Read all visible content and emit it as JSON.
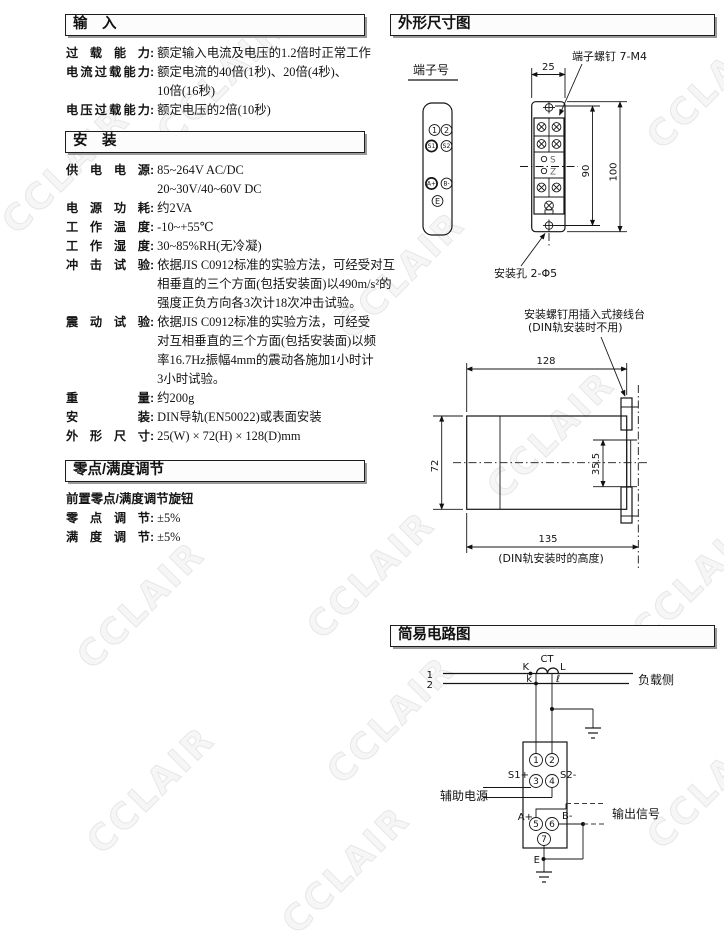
{
  "ui": {
    "colon": ":"
  },
  "watermark": {
    "text": "CCLAIR"
  },
  "input_section": {
    "title": "输　入",
    "rows": [
      {
        "label": "过载能力",
        "value": "额定输入电流及电压的1.2倍时正常工作"
      },
      {
        "label": "电流过载能力",
        "value": "额定电流的40倍(1秒)、20倍(4秒)、\n10倍(16秒)"
      },
      {
        "label": "电压过载能力",
        "value": "额定电压的2倍(10秒)"
      }
    ]
  },
  "install_section": {
    "title": "安　装",
    "rows": [
      {
        "label": "供电电源",
        "value": "85~264V AC/DC\n20~30V/40~60V DC"
      },
      {
        "label": "电源功耗",
        "value": "约2VA"
      },
      {
        "label": "工作温度",
        "value": "-10~+55℃"
      },
      {
        "label": "工作湿度",
        "value": "30~85%RH(无冷凝)"
      },
      {
        "label": "冲击试验",
        "value": "依据JIS C0912标准的实验方法，可经受对互\n相垂直的三个方面(包括安装面)以490m/s²的\n强度正负方向各3次计18次冲击试验。"
      },
      {
        "label": "震动试验",
        "value": "依据JIS C0912标准的实验方法，可经受\n对互相垂直的三个方面(包括安装面)以频\n率16.7Hz振幅4mm的震动各施加1小时计\n3小时试验。"
      },
      {
        "label": "重量",
        "value": "约200g"
      },
      {
        "label": "安装",
        "value": "DIN导轨(EN50022)或表面安装"
      },
      {
        "label": "外形尺寸",
        "value": "25(W) × 72(H) × 128(D)mm"
      }
    ]
  },
  "adjust_section": {
    "title": "零点/满度调节",
    "note": "前置零点/满度调节旋钮",
    "rows": [
      {
        "label": "零点调节",
        "value": "±5%"
      },
      {
        "label": "满度调节",
        "value": "±5%"
      }
    ]
  },
  "dims": {
    "title": "外形尺寸图",
    "terminal_no": {
      "label": "端子号",
      "t1": "1",
      "t2": "2",
      "s1": "S1",
      "s2": "S2",
      "ap": "A+",
      "bm": "B-",
      "e": "E"
    },
    "front": {
      "screw_note": "端子螺钉 7-M4",
      "width": "25",
      "h_inner": "90",
      "h_outer": "100",
      "hole_note": "安装孔 2-Φ5",
      "s": "S",
      "z": "Z"
    },
    "side": {
      "plug_note1": "安装螺钉用插入式接线台",
      "plug_note2": "(DIN轨安装时不用)",
      "d128": "128",
      "d72": "72",
      "d355": "35.5",
      "d135": "135",
      "din_note": "(DIN轨安装时的高度)"
    }
  },
  "circuit": {
    "title": "简易电路图",
    "line1": "1",
    "line2": "2",
    "K": "K",
    "CT": "CT",
    "L": "L",
    "k": "k",
    "l": "ℓ",
    "load": "负载侧",
    "terminals": [
      "1",
      "2",
      "3",
      "4",
      "5",
      "6",
      "7"
    ],
    "s1": "S1+",
    "s2": "S2-",
    "ap": "A+",
    "bm": "B-",
    "e": "E",
    "aux": "辅助电源",
    "out": "输出信号"
  }
}
